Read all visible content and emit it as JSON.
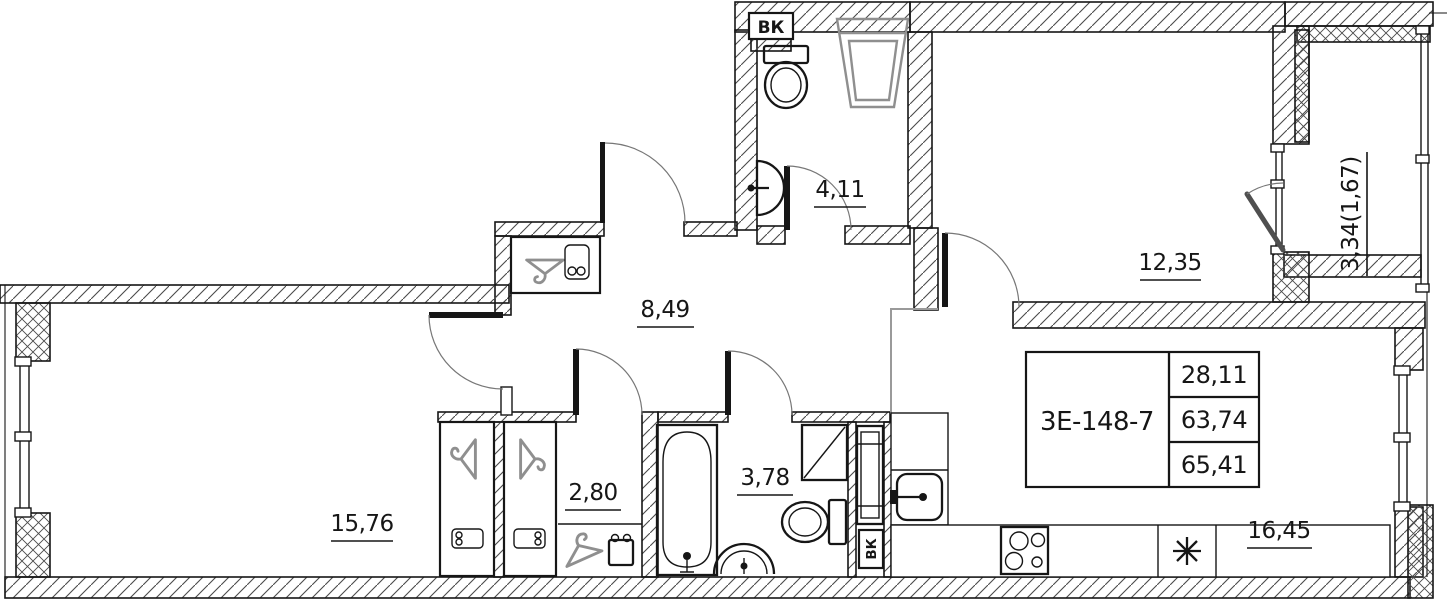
{
  "title_block": {
    "unit": "3Е-148-7",
    "rows": [
      "28,11",
      "63,74",
      "65,41"
    ]
  },
  "rooms": {
    "wc": {
      "area": "4,11"
    },
    "bedroom": {
      "area": "12,35"
    },
    "balcony": {
      "area": "3,34(1,67)"
    },
    "hall": {
      "area": "8,49"
    },
    "wardrobe": {
      "area": "2,80"
    },
    "bathroom": {
      "area": "3,78"
    },
    "living": {
      "area": "15,76"
    },
    "kitchen": {
      "area": "16,45"
    }
  },
  "ducts": {
    "top": "ВК",
    "bottom": "ВК"
  },
  "colors": {
    "wall": "#161616",
    "hatch": "#4a4a4a",
    "fixture_gray": "#8f8f8f",
    "zone_line": "#9a9a9a"
  }
}
